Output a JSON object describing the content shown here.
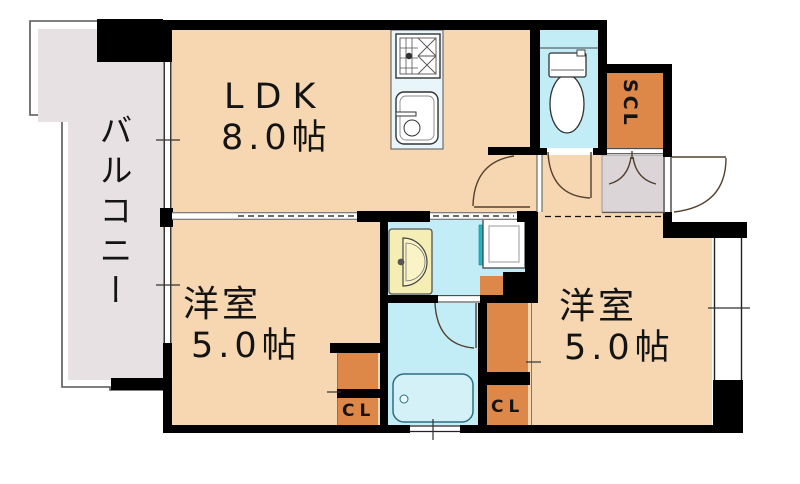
{
  "floorplan": {
    "balcony": {
      "label": "バルコニー"
    },
    "ldk": {
      "label": "LDK",
      "size": "8.0帖"
    },
    "bedroom_left": {
      "label": "洋室",
      "size": "5.0帖"
    },
    "bedroom_right": {
      "label": "洋室",
      "size": "5.0帖"
    },
    "shoe_closet": {
      "label": "SCL"
    },
    "closet_left": {
      "label": "CL"
    },
    "closet_right": {
      "label": "CL"
    },
    "colors": {
      "wall": "#000000",
      "room_fill": "#f6d7b2",
      "wet_area_fill": "#c2edf6",
      "balcony_fill": "#e7e1e4",
      "entrance_fill": "#dcd5d8",
      "closet_fill": "#dd8849",
      "washbasin_fill": "#f5eeb4",
      "kitchen_counter_fill": "#e8f5fa",
      "accent_teal": "#1fb7c4"
    }
  }
}
